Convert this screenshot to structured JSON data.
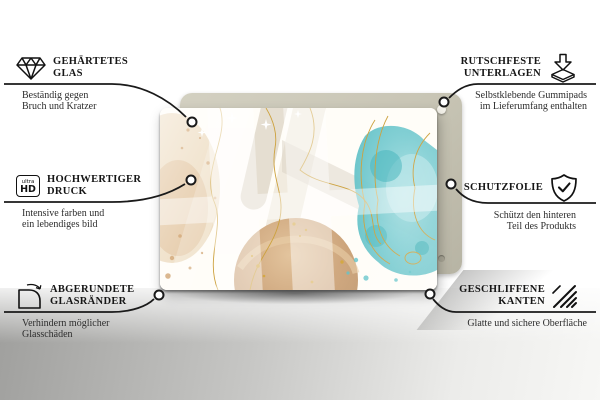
{
  "product": {
    "description": "Glass panel with abstract pastel watercolor artwork",
    "backing": "Mounting board with self-adhesive rubber pads"
  },
  "callouts": {
    "left": [
      {
        "icon": "diamond-icon",
        "title_line1": "GEHÄRTETES",
        "title_line2": "GLAS",
        "subtitle_line1": "Beständig gegen",
        "subtitle_line2": "Bruch und Kratzer"
      },
      {
        "icon": "ultra-hd-icon",
        "icon_label_top": "ultra",
        "icon_label_bottom": "HD",
        "title_line1": "HOCHWERTIGER",
        "title_line2": "DRUCK",
        "subtitle_line1": "Intensive farben und",
        "subtitle_line2": "ein lebendiges bild"
      },
      {
        "icon": "rounded-corner-icon",
        "title_line1": "ABGERUNDETE",
        "title_line2": "GLASRÄNDER",
        "subtitle_line1": "Verhindern möglicher",
        "subtitle_line2": "Glasschäden"
      }
    ],
    "right": [
      {
        "icon": "non-slip-pads-icon",
        "title_line1": "RUTSCHFESTE",
        "title_line2": "UNTERLAGEN",
        "subtitle_line1": "Selbstklebende Gummipads",
        "subtitle_line2": "im Lieferumfang enthalten"
      },
      {
        "icon": "shield-check-icon",
        "title_line1": "SCHUTZFOLIE",
        "title_line2": "",
        "subtitle_line1": "Schützt den hinteren",
        "subtitle_line2": "Teil des Produkts"
      },
      {
        "icon": "polished-edges-icon",
        "title_line1": "GESCHLIFFENE",
        "title_line2": "KANTEN",
        "subtitle_line1": "Glatte und sichere Oberfläche",
        "subtitle_line2": ""
      }
    ]
  },
  "colors": {
    "text": "#1a1a1a",
    "connector_line": "#1a1a1a",
    "board": "#c8c5b5",
    "art_teal": "#79cbd1",
    "art_beige": "#e9d6ba",
    "art_tan": "#c69a6d",
    "art_gold": "#cda23f",
    "floor_gray": "#a8a8a6"
  }
}
